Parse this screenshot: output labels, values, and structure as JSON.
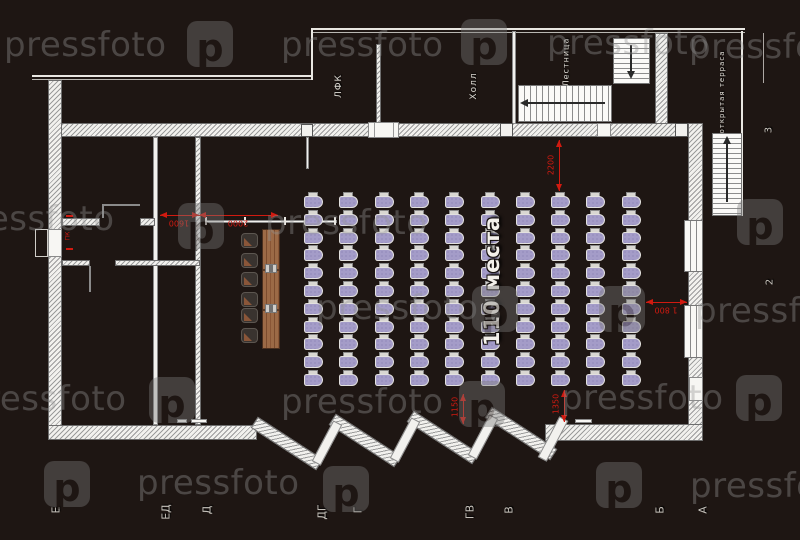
{
  "watermark": {
    "text": "pressfoto",
    "logo_glyph": "p",
    "instances": [
      {
        "type": "text",
        "x": 4,
        "y": 25
      },
      {
        "type": "logo",
        "x": 187,
        "y": 21
      },
      {
        "type": "text",
        "x": 281,
        "y": 25
      },
      {
        "type": "logo",
        "x": 461,
        "y": 19
      },
      {
        "type": "text",
        "x": 547,
        "y": 23
      },
      {
        "type": "text",
        "x": 689,
        "y": 27
      },
      {
        "type": "text",
        "x": -48,
        "y": 199
      },
      {
        "type": "logo",
        "x": 178,
        "y": 203
      },
      {
        "type": "text",
        "x": 265,
        "y": 203
      },
      {
        "type": "logo",
        "x": 737,
        "y": 199
      },
      {
        "type": "text",
        "x": 316,
        "y": 288
      },
      {
        "type": "logo",
        "x": 472,
        "y": 286
      },
      {
        "type": "logo",
        "x": 599,
        "y": 286
      },
      {
        "type": "text",
        "x": 695,
        "y": 291
      },
      {
        "type": "text",
        "x": -36,
        "y": 379
      },
      {
        "type": "logo",
        "x": 149,
        "y": 377
      },
      {
        "type": "text",
        "x": 281,
        "y": 382
      },
      {
        "type": "logo",
        "x": 459,
        "y": 381
      },
      {
        "type": "text",
        "x": 561,
        "y": 378
      },
      {
        "type": "logo",
        "x": 736,
        "y": 375
      },
      {
        "type": "logo",
        "x": 44,
        "y": 461
      },
      {
        "type": "text",
        "x": 137,
        "y": 463
      },
      {
        "type": "logo",
        "x": 323,
        "y": 466
      },
      {
        "type": "logo",
        "x": 596,
        "y": 462
      },
      {
        "type": "text",
        "x": 690,
        "y": 466
      }
    ]
  },
  "rooms": [
    {
      "id": "lfk",
      "label": "ЛФК",
      "x": 339,
      "y": 86,
      "size": 9
    },
    {
      "id": "hall",
      "label": "Холл",
      "x": 474,
      "y": 86,
      "size": 9
    },
    {
      "id": "staircase",
      "label": "Лестница",
      "x": 566,
      "y": 62,
      "size": 8
    },
    {
      "id": "terrace",
      "label": "открытая терраса",
      "x": 722,
      "y": 92,
      "size": 7
    }
  ],
  "auditorium": {
    "label": "110 места",
    "label_x": 492,
    "label_y": 281,
    "label_size": 21,
    "seats": {
      "cols": 10,
      "rows": 11,
      "x0": 304,
      "y0": 192,
      "dx": 35.3,
      "dy": 17.8
    }
  },
  "presidium": {
    "chair_x": 241,
    "chairs_y": [
      233,
      253,
      272,
      292,
      308,
      328
    ]
  },
  "door_label": {
    "text": "ПК",
    "x": 68,
    "y": 236
  },
  "dimensions": [
    {
      "label": "1600",
      "orient": "h",
      "x1": 160,
      "x2": 199,
      "y": 215,
      "tx": 179,
      "ty": 223,
      "trot": 180
    },
    {
      "label": "2000",
      "orient": "h",
      "x1": 199,
      "x2": 278,
      "y": 215,
      "tx": 238,
      "ty": 223,
      "trot": 180
    },
    {
      "label": "2200",
      "orient": "v",
      "x": 559,
      "y1": 140,
      "y2": 191,
      "tx": 551,
      "ty": 165,
      "trot": -90
    },
    {
      "label": "1 800",
      "orient": "h",
      "x1": 646,
      "x2": 687,
      "y": 302,
      "tx": 666,
      "ty": 310,
      "trot": 180
    },
    {
      "label": "1150",
      "orient": "v",
      "x": 463,
      "y1": 394,
      "y2": 424,
      "tx": 455,
      "ty": 407,
      "trot": -90
    },
    {
      "label": "1350",
      "orient": "v",
      "x": 564,
      "y1": 390,
      "y2": 422,
      "tx": 556,
      "ty": 404,
      "trot": -90
    }
  ],
  "axis_letters": [
    {
      "t": "Е",
      "x": 56,
      "y": 510
    },
    {
      "t": "ЕД",
      "x": 166,
      "y": 512
    },
    {
      "t": "Д",
      "x": 207,
      "y": 510
    },
    {
      "t": "ДГ",
      "x": 322,
      "y": 512
    },
    {
      "t": "Г",
      "x": 358,
      "y": 510
    },
    {
      "t": "ГВ",
      "x": 470,
      "y": 512
    },
    {
      "t": "В",
      "x": 509,
      "y": 510
    },
    {
      "t": "Б",
      "x": 660,
      "y": 510
    },
    {
      "t": "А",
      "x": 703,
      "y": 510
    }
  ],
  "axis_numbers": [
    {
      "t": "3",
      "x": 769,
      "y": 130
    },
    {
      "t": "2",
      "x": 770,
      "y": 282
    }
  ],
  "colors": {
    "background": "#1e1613",
    "wall": "#f2f1ee",
    "hatch_line": "#9b9b9b",
    "dimension_red": "#d11a10",
    "seat_purple": "#a49cc8",
    "seat_speckle": "#8177ad",
    "table_wood": "#9c6a46",
    "label_text": "#dedbd4",
    "watermark_gray": "#949494"
  }
}
